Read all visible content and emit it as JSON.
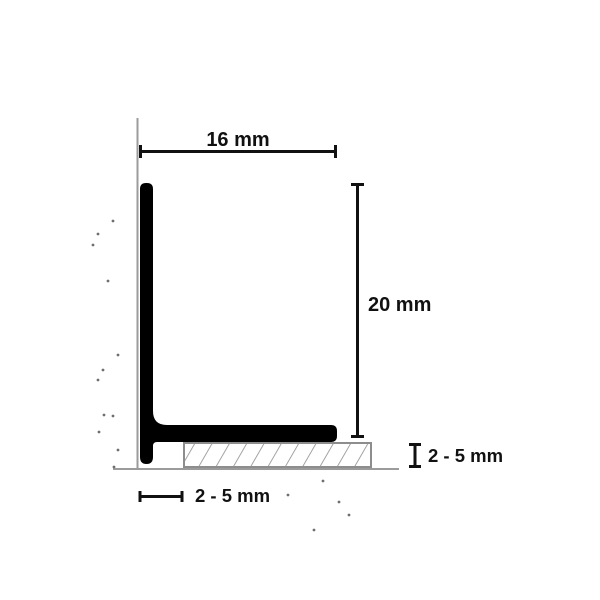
{
  "diagram": {
    "title": "L-profile cross-section with dimensions",
    "dimensions": {
      "top_width": "16 mm",
      "right_height": "20 mm",
      "wall_gap": "2 - 5 mm",
      "tile_thickness": "2 - 5 mm"
    }
  },
  "colors": {
    "background": "#ffffff",
    "profile": "#000000",
    "dimension": "#111111",
    "text": "#111111",
    "surface-line": "#9b9b9b",
    "tile-border": "#8d8d8d",
    "tile-hatch": "#8d8d8d",
    "tile-fill": "#ffffff",
    "speckle": "#6f6f6f"
  }
}
